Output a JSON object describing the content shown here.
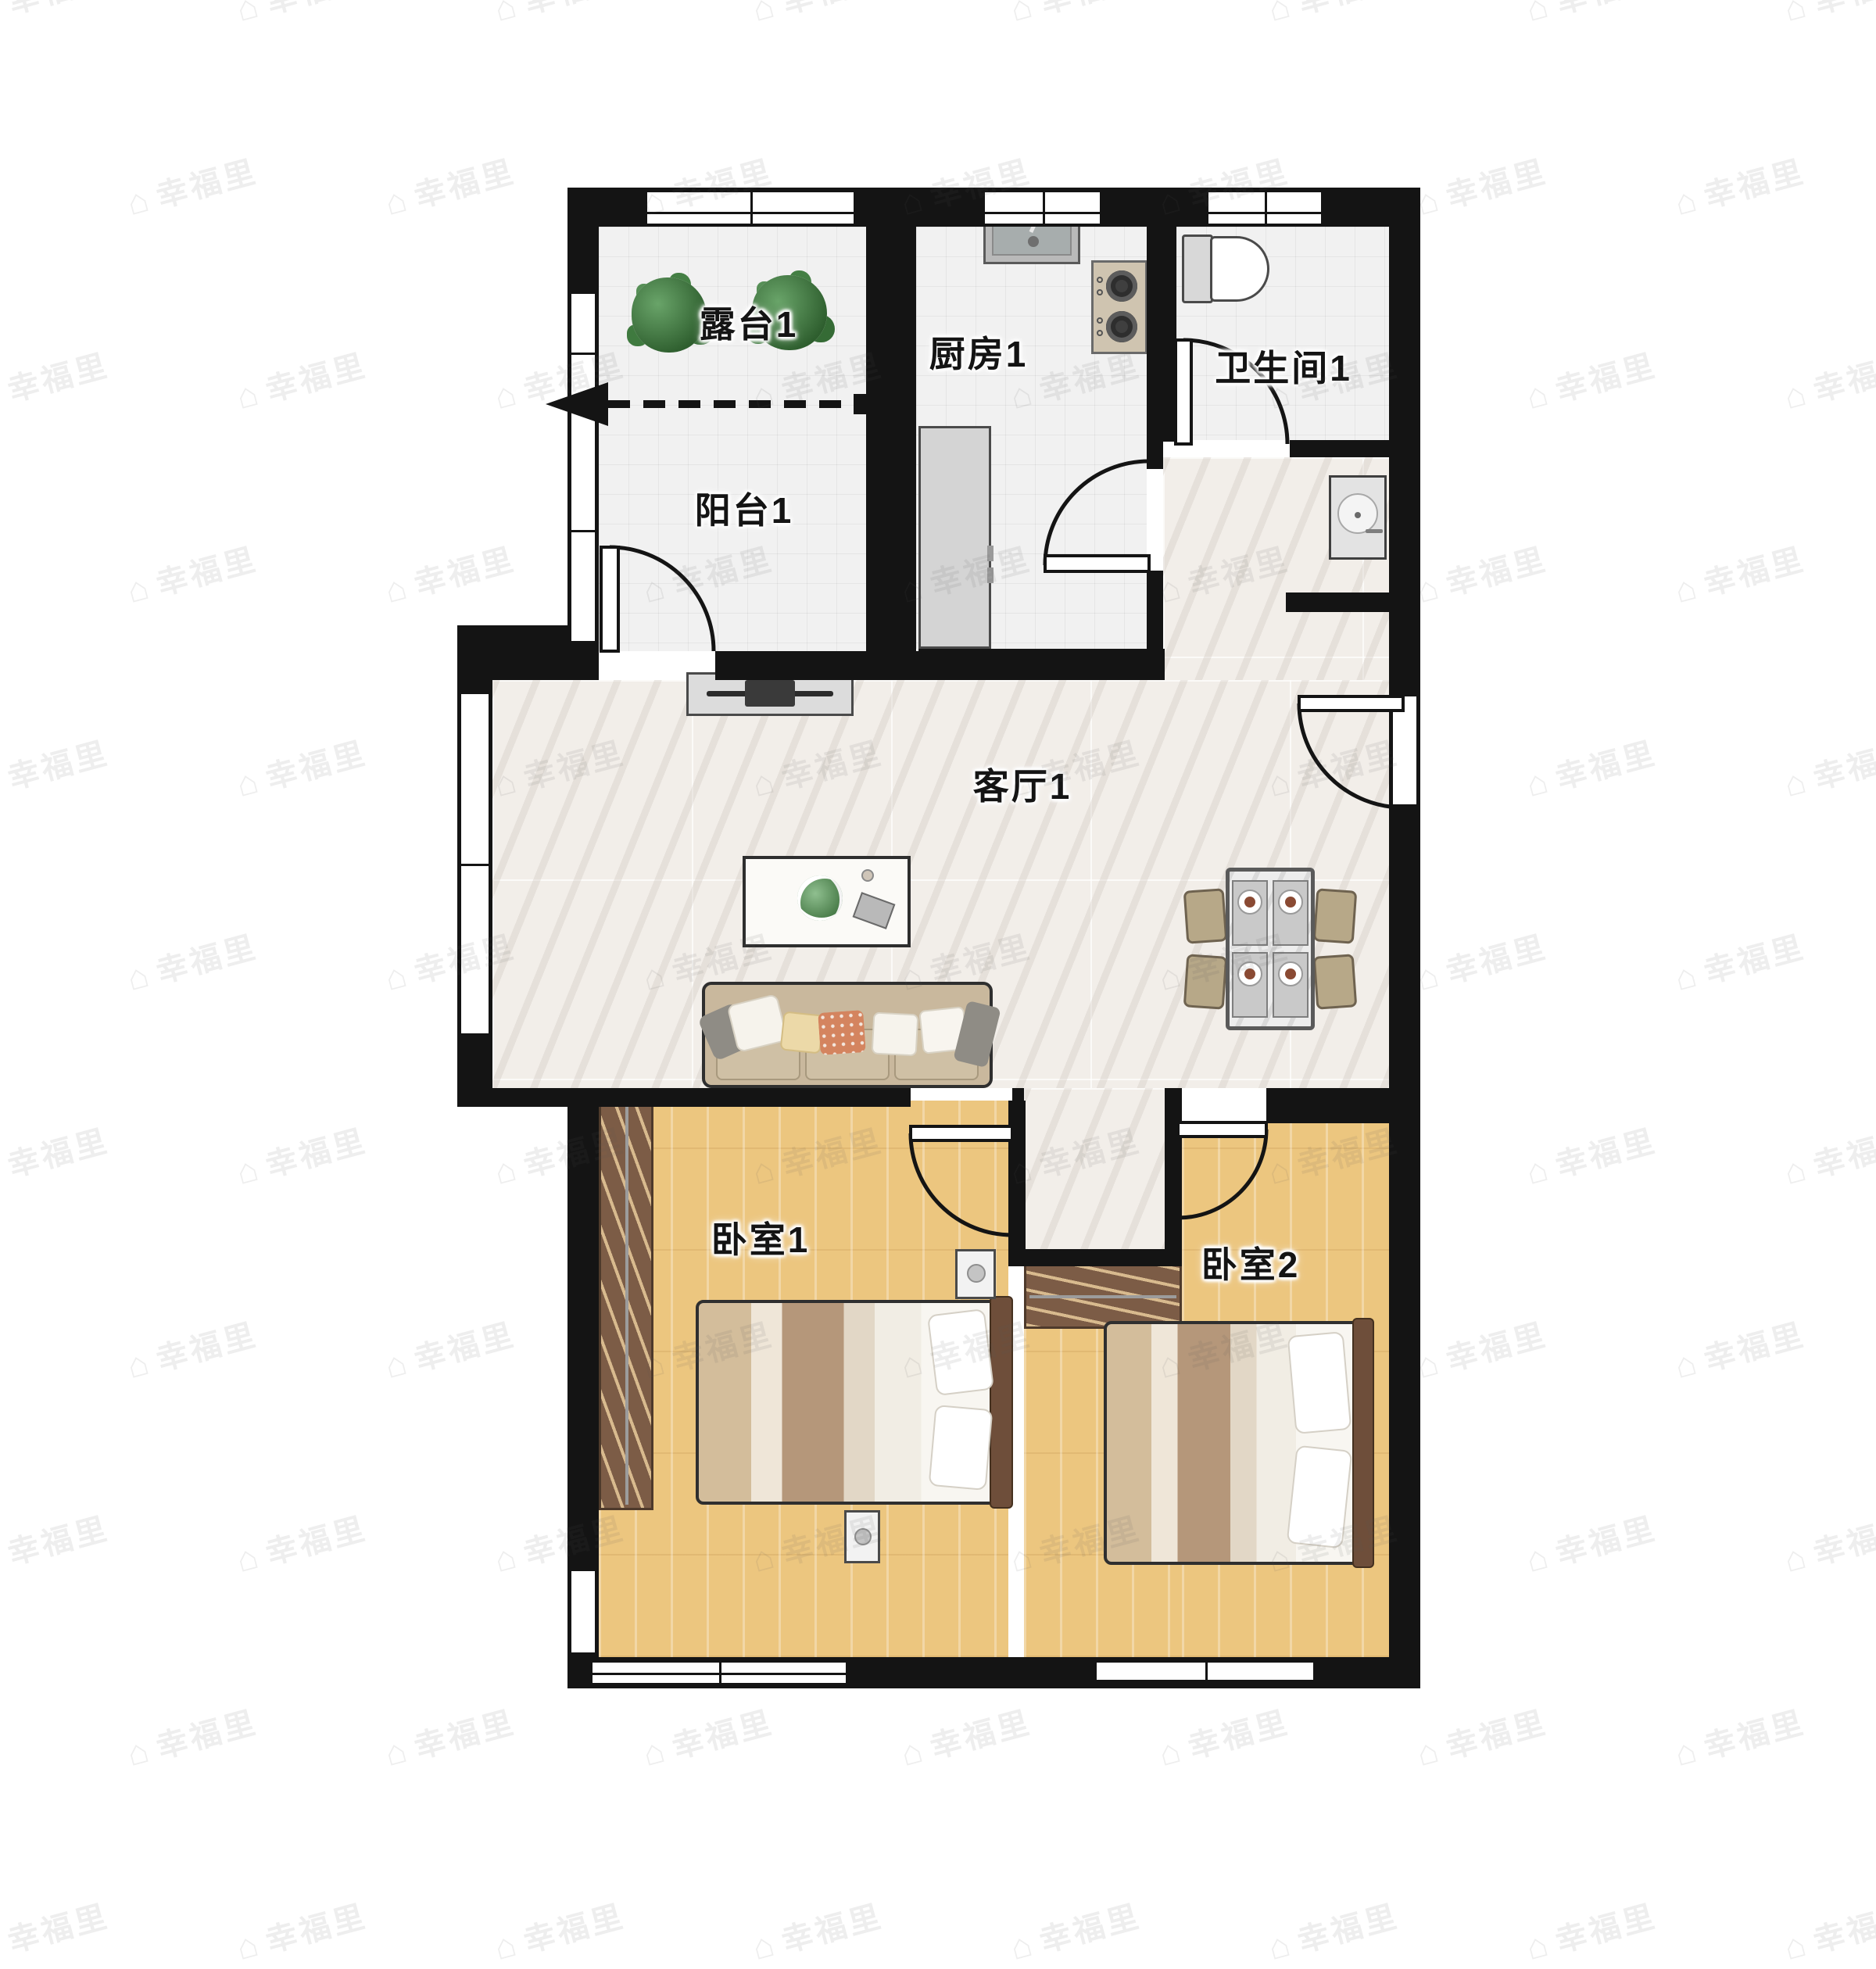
{
  "watermark": {
    "text": "幸福里",
    "icon": "house-icon",
    "icon_glyph": "⌂"
  },
  "rooms": {
    "terrace": {
      "label": "露台1"
    },
    "balcony": {
      "label": "阳台1"
    },
    "kitchen": {
      "label": "厨房1"
    },
    "bathroom": {
      "label": "卫生间1"
    },
    "living": {
      "label": "客厅1"
    },
    "bedroom1": {
      "label": "卧室1"
    },
    "bedroom2": {
      "label": "卧室2"
    }
  },
  "colors": {
    "wall": "#141414",
    "tile_floor": "#f1f1f1",
    "marble_floor": "#f2eee9",
    "wood_floor": "#ecc67f",
    "wardrobe_brown": "#7c5c46",
    "sofa_tan": "#c9b89d",
    "accent_pillow_orange": "#d4845f",
    "label_text": "#141414"
  },
  "icons": [
    "plant-icon",
    "tv-icon",
    "sofa-icon",
    "coffee-table-icon",
    "dining-table-icon",
    "chair-icon",
    "bed-icon",
    "pillow-icon",
    "wardrobe-icon",
    "nightstand-icon",
    "fridge-icon",
    "kitchen-sink-icon",
    "stove-icon",
    "toilet-icon",
    "washbasin-icon",
    "door-swing-icon",
    "window-icon",
    "dashed-divider-arrow-icon",
    "house-icon"
  ]
}
